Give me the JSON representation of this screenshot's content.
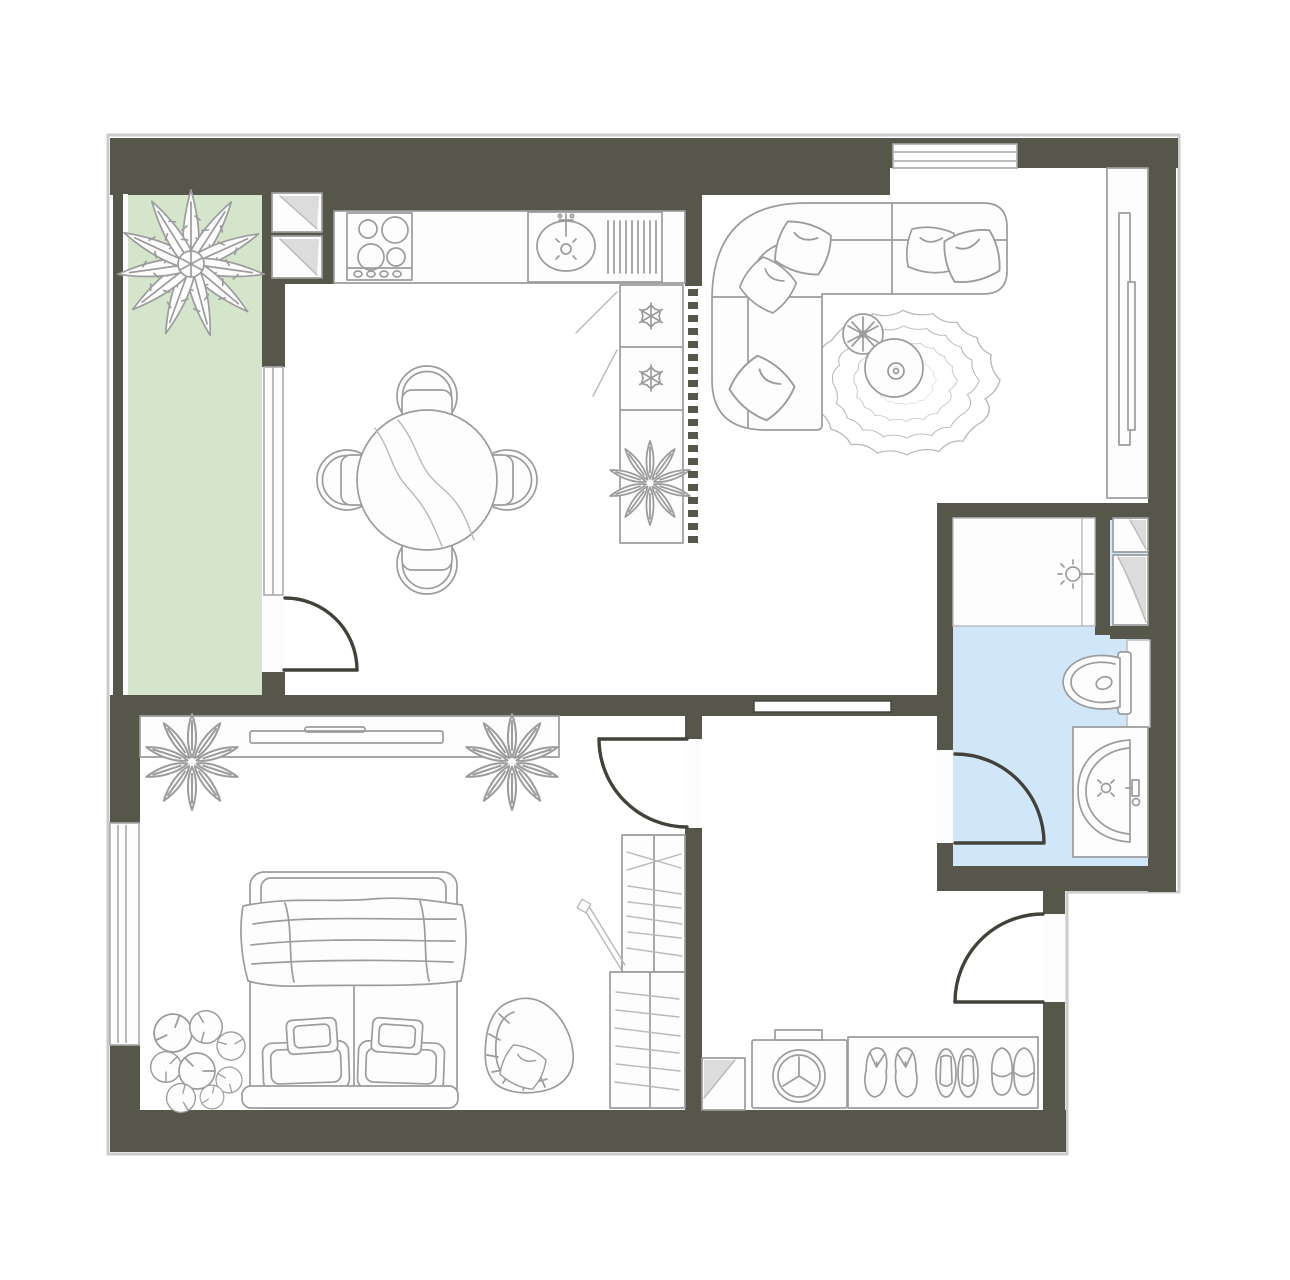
{
  "title": "apartment-floor-plan",
  "canvas": {
    "width": 1290,
    "height": 1280
  },
  "colors": {
    "wall": "#57564a",
    "wallDark": "#42413a",
    "floor": "#fdfdfd",
    "balcony": "#d5e5cc",
    "bath": "#cfe7f8",
    "stroke": "#9c9c9c",
    "strokeLight": "#b9b9b9",
    "glass": "#a9a9a9",
    "fold": "#dcdcdc",
    "outline": "#cbcbcb"
  },
  "rooms": [
    {
      "id": "balcony",
      "floor_color": "#d5e5cc",
      "fixtures": [
        "palm-plant"
      ]
    },
    {
      "id": "kitchen-dining",
      "floor_color": "#fdfdfd",
      "fixtures": [
        "wall-cabinet",
        "wall-cabinet",
        "stove-4-burners",
        "counter",
        "kitchen-sink-drainboard",
        "fridge-freezer-2-snowflakes",
        "column-plant",
        "slat-partition",
        "round-dining-table",
        "chair",
        "chair",
        "chair",
        "chair"
      ]
    },
    {
      "id": "living-room",
      "floor_color": "#fdfdfd",
      "fixtures": [
        "corner-sofa",
        "pillow",
        "pillow",
        "pillow",
        "pillow",
        "pillow",
        "wavy-rug",
        "coffee-table",
        "small-plant",
        "tv-console",
        "tv"
      ]
    },
    {
      "id": "bedroom",
      "floor_color": "#fdfdfd",
      "fixtures": [
        "media-shelf",
        "tv",
        "fern-plant",
        "fern-plant",
        "double-bed",
        "pillows",
        "blanket",
        "monstera-floor-plant",
        "bean-bag-chair",
        "open-wardrobe"
      ]
    },
    {
      "id": "hallway",
      "floor_color": "#fdfdfd",
      "fixtures": [
        "corner-cabinet",
        "washing-machine",
        "shoe-rack",
        "flip-flops",
        "open-slippers",
        "closed-slippers"
      ]
    },
    {
      "id": "bathroom",
      "floor_color": "#cfe7f8",
      "fixtures": [
        "shower-area",
        "ceiling-lamp",
        "storage-cabinet",
        "storage-cabinet",
        "toilet",
        "wash-basin"
      ]
    }
  ],
  "openings": {
    "doors": [
      "balcony-door",
      "bedroom-door",
      "bathroom-door",
      "entrance-door",
      "sliding-door-living"
    ],
    "windows": [
      "living-room-top-window",
      "bedroom-left-window",
      "balcony-glazing"
    ]
  }
}
